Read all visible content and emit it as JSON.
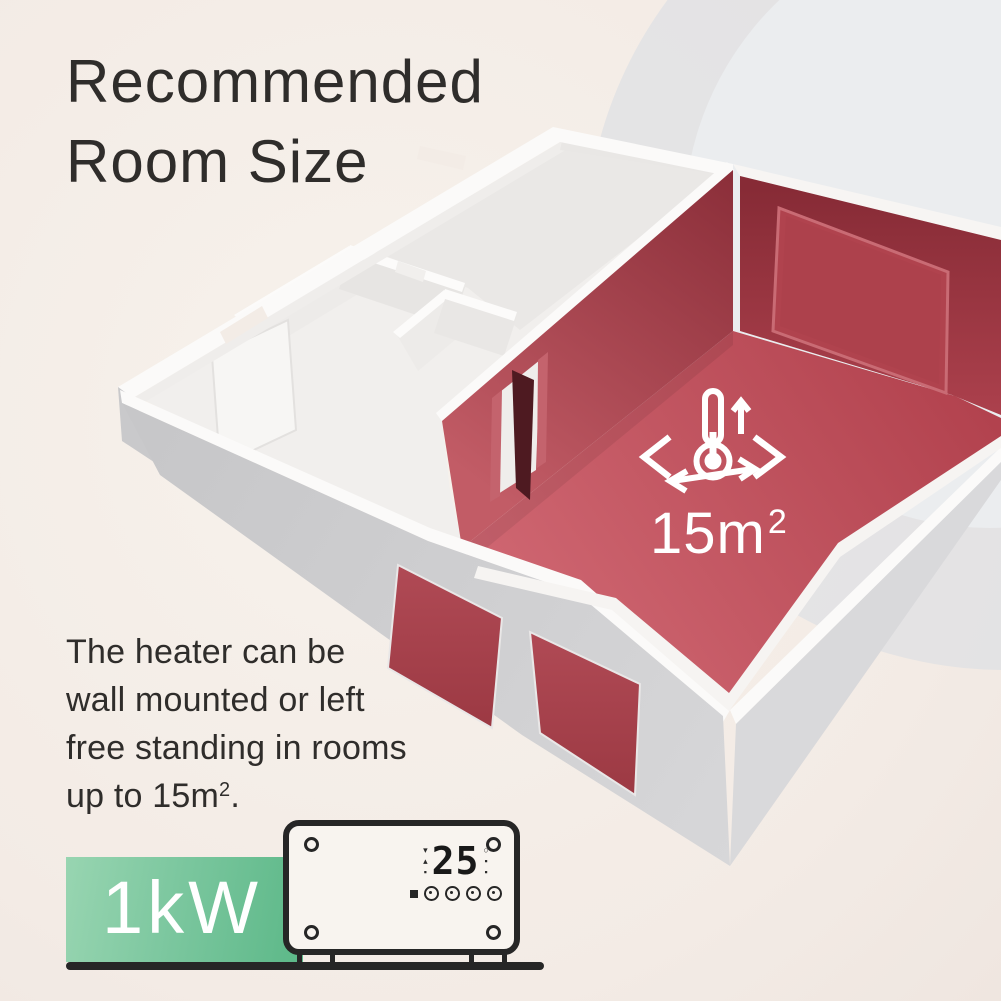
{
  "title": {
    "line1": "Recommended",
    "line2": "Room Size"
  },
  "description": {
    "line1": "The heater can be",
    "line2": "wall mounted or left",
    "line3": "free standing in rooms",
    "line4_prefix": "up to 15m",
    "line4_sup": "2",
    "line4_suffix": "."
  },
  "highlighted_room": {
    "area_value": "15m",
    "area_sup": "2"
  },
  "badge": {
    "power": "1kW"
  },
  "heater_display": {
    "temperature": "25"
  },
  "colors": {
    "background": "#f4ede7",
    "accent_red_wall": "#a03744",
    "floor_red": "#c2525e",
    "badge_green": "#6fc096",
    "text": "#2f2d2b",
    "outline": "#262626",
    "background_circle": "#e0e2e4"
  }
}
